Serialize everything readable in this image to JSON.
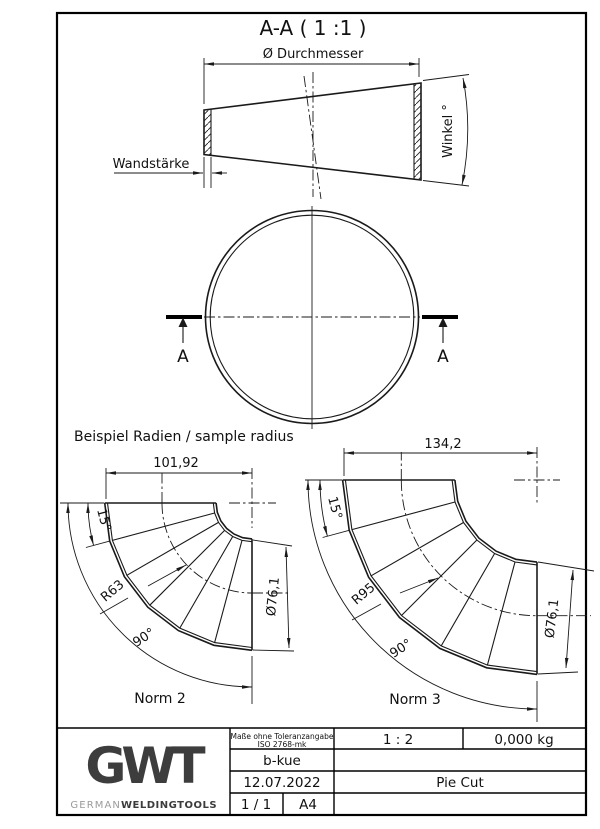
{
  "drawing": {
    "section_title": "A-A ( 1 :1 )",
    "dim_diameter": "Ø Durchmesser",
    "dim_wall": "Wandstärke",
    "dim_angle": "Winkel °",
    "section_label_left": "A",
    "section_label_right": "A",
    "sample_heading": "Beispiel Radien / sample radius",
    "norm2": {
      "width": "101,92",
      "segment_angle": "15°",
      "radius": "R63",
      "total_angle": "90°",
      "diameter": "Ø76,1",
      "label": "Norm 2"
    },
    "norm3": {
      "width": "134,2",
      "segment_angle": "15°",
      "radius": "R95",
      "total_angle": "90°",
      "diameter": "Ø76,1",
      "label": "Norm 3"
    }
  },
  "title_block": {
    "tolerance_line1": "Maße ohne Toleranzangabe",
    "tolerance_line2": "ISO 2768-mk",
    "scale": "1 : 2",
    "weight": "0,000 kg",
    "author": "b-kue",
    "date": "12.07.2022",
    "title": "Pie Cut",
    "sheet": "1 / 1",
    "format": "A4",
    "logo_text": "GWT",
    "brand_light": "GERMAN",
    "brand_bold": "WELDINGTOOLS"
  }
}
